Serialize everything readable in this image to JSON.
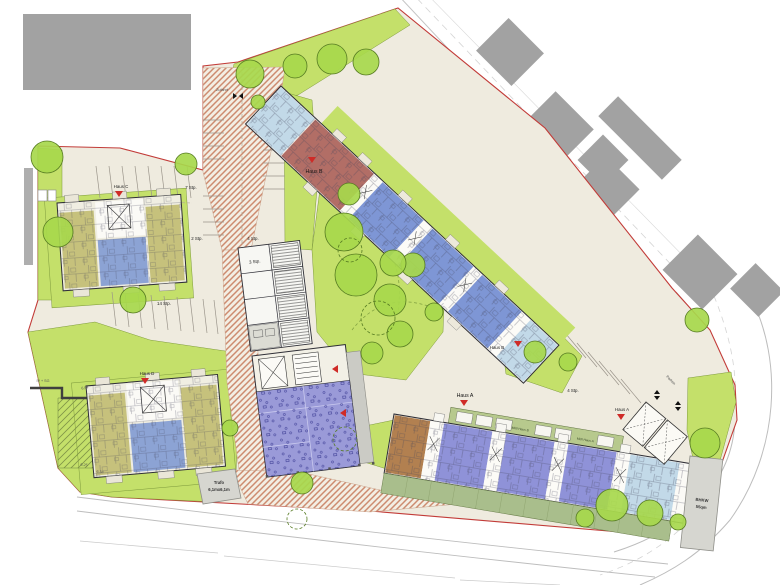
{
  "drawing": {
    "type": "architectural-site-plan",
    "houses": [
      "Haus A",
      "Haus B",
      "Haus C",
      "Haus D"
    ]
  },
  "labels": {
    "haus_a": "Haus A",
    "haus_b": "Haus B",
    "haus_c": "Haus C",
    "haus_d": "Haus D",
    "zufahrt": "Zufahrt",
    "parken": "Parken",
    "stp_7": "7 Stp.",
    "stp_2": "2 Stp.",
    "stp_4": "4 Stp.",
    "stp_14": "14 Stp.",
    "stp_3": "3 Stp.",
    "muell_haus_a": "Müll Haus A",
    "muell_haus_b": "Müll Haus B",
    "trafo_line1": "Trafo",
    "trafo_line2": "6,1mx6,1m",
    "bhkw_line1": "BHKW",
    "bhkw_line2": "55qm",
    "floors_note": "IV + SG",
    "dim_a": "6,54",
    "dim_b": "6,25",
    "dim_c": "6,34"
  },
  "palette": {
    "boundary_red": "#C23B38",
    "site_beige": "#EFEBDF",
    "green": "#C4E06A",
    "tree_green": "#A7D84C",
    "paving_hatch": "#CD8B6F",
    "neighbor_gray": "#A5A5A5",
    "unit_blue": "#7E96D5",
    "unit_purple": "#8F92D8",
    "unit_maroon": "#B26E66",
    "unit_olive": "#C6C17C",
    "unit_pale_blue": "#C2D9E8",
    "unit_brown": "#B28050",
    "garden_sage": "#A9BE8C",
    "entrance_marker": "#CF2B27"
  }
}
